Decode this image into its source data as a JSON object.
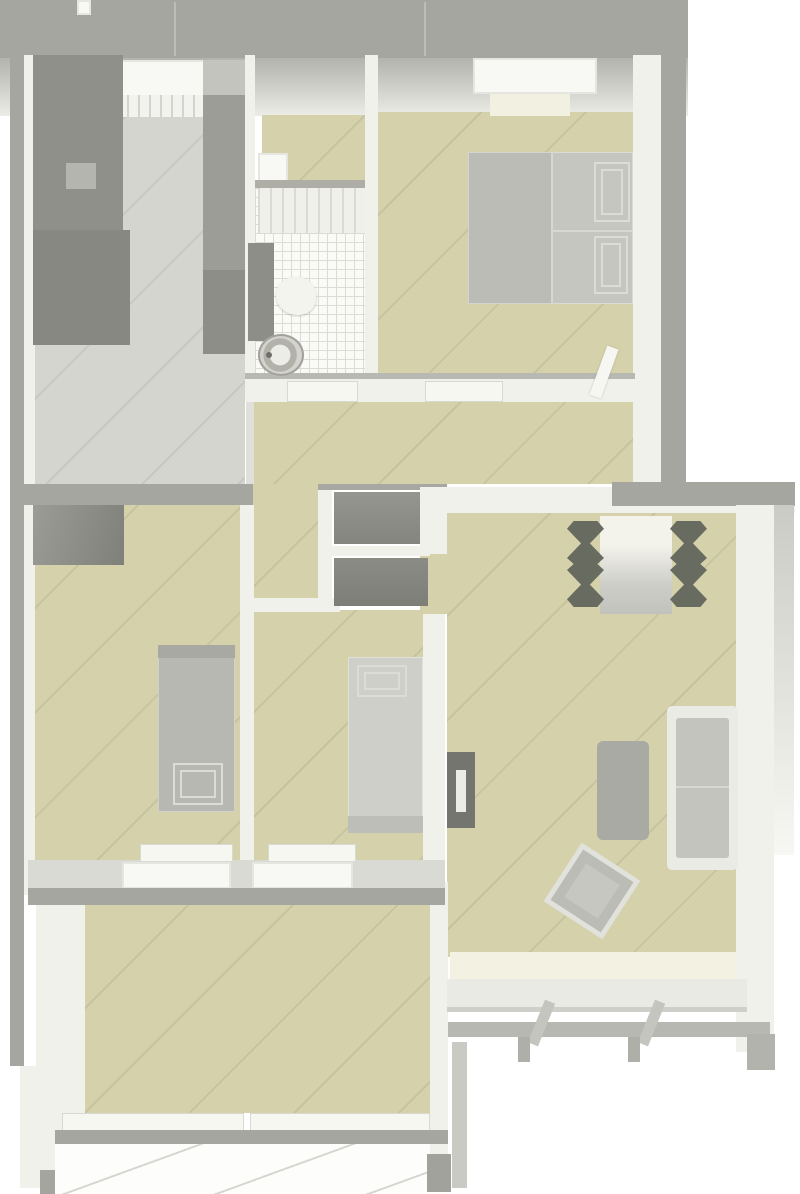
{
  "scene": {
    "width": 800,
    "height": 1194,
    "background": "#ffffff"
  },
  "palette": {
    "background": "#ffffff",
    "exterior_wall": "#a6a6a1",
    "interior_wall": "#f0f1eb",
    "floor_wood_beige": "#d5d2ab",
    "floor_kitchen_gray": "#d4d5ce",
    "floor_bathroom_tile": "#fafaf7",
    "balcony_tile": "#fdfdfb",
    "furniture_light": "#c6c6c1",
    "furniture_dark": "#8f908a",
    "chair_dark": "#686b60"
  },
  "rooms": [
    {
      "name": "kitchen",
      "x": 35,
      "y": 55,
      "w": 210,
      "h": 429
    },
    {
      "name": "bathroom",
      "x": 255,
      "y": 115,
      "w": 110,
      "h": 258
    },
    {
      "name": "bedroom",
      "x": 378,
      "y": 112,
      "w": 255,
      "h": 261
    },
    {
      "name": "hallway",
      "x": 253,
      "y": 402,
      "w": 380,
      "h": 208
    },
    {
      "name": "bedroom-left",
      "x": 35,
      "y": 505,
      "w": 205,
      "h": 357
    },
    {
      "name": "child-room",
      "x": 253,
      "y": 610,
      "w": 170,
      "h": 252
    },
    {
      "name": "living-room",
      "x": 447,
      "y": 513,
      "w": 289,
      "h": 444
    },
    {
      "name": "bottom-room",
      "x": 85,
      "y": 905,
      "w": 345,
      "h": 208
    },
    {
      "name": "balcony",
      "x": 55,
      "y": 1143,
      "w": 393,
      "h": 51
    }
  ],
  "items": [
    {
      "name": "top-exterior-wall",
      "kind": "wall-gray",
      "x": 0,
      "y": 0,
      "w": 688,
      "h": 58
    },
    {
      "name": "top-wall-notch",
      "kind": "window",
      "x": 77,
      "y": 0,
      "w": 14,
      "h": 15
    },
    {
      "name": "top-wall-seam-a",
      "kind": "seam-faint",
      "x": 174,
      "y": 2,
      "w": 2,
      "h": 54
    },
    {
      "name": "top-wall-seam-b",
      "kind": "seam-faint",
      "x": 424,
      "y": 2,
      "w": 2,
      "h": 54
    },
    {
      "name": "north-wall-fade",
      "kind": "fade-n",
      "x": 0,
      "y": 58,
      "w": 688,
      "h": 58
    },
    {
      "name": "left-exterior-wall",
      "kind": "wall-gray",
      "x": 10,
      "y": 44,
      "w": 14,
      "h": 1022
    },
    {
      "name": "left-interior-wall",
      "kind": "wall-white",
      "x": 24,
      "y": 55,
      "w": 12,
      "h": 840
    },
    {
      "name": "lowerleft-interior-wall",
      "kind": "wall-white",
      "x": 36,
      "y": 896,
      "w": 49,
      "h": 276
    },
    {
      "name": "lowerleft-wall-base",
      "kind": "wall-white",
      "x": 20,
      "y": 1066,
      "w": 24,
      "h": 122
    },
    {
      "name": "lowerleft-wall-foot",
      "kind": "rect",
      "color": "#a5a5a0",
      "x": 40,
      "y": 1170,
      "w": 48,
      "h": 24
    },
    {
      "name": "right-interior-wall",
      "kind": "wall-white",
      "x": 633,
      "y": 55,
      "w": 28,
      "h": 433
    },
    {
      "name": "right-exterior-wall",
      "kind": "wall-gray",
      "x": 661,
      "y": 44,
      "w": 25,
      "h": 444
    },
    {
      "name": "kitchen-floor",
      "kind": "floor-gray",
      "x": 35,
      "y": 112,
      "w": 210,
      "h": 372
    },
    {
      "name": "anteroom-floor",
      "kind": "floor-beige",
      "x": 262,
      "y": 115,
      "w": 103,
      "h": 65
    },
    {
      "name": "anteroom-fixture",
      "kind": "window",
      "x": 258,
      "y": 153,
      "w": 30,
      "h": 29
    },
    {
      "name": "anteroom-wall-line",
      "kind": "rect",
      "color": "#aeaea7",
      "x": 245,
      "y": 180,
      "w": 120,
      "h": 8
    },
    {
      "name": "bathroom-tile-floor",
      "kind": "tile-floor",
      "x": 255,
      "y": 188,
      "w": 110,
      "h": 185
    },
    {
      "name": "bathroom-shower-zone",
      "kind": "shower",
      "x": 258,
      "y": 188,
      "w": 107,
      "h": 45
    },
    {
      "name": "bedroom-floor",
      "kind": "floor-beige",
      "x": 378,
      "y": 112,
      "w": 255,
      "h": 261
    },
    {
      "name": "hallway-floor",
      "kind": "floor-beige",
      "x": 253,
      "y": 402,
      "w": 380,
      "h": 82
    },
    {
      "name": "hallway-floor-left",
      "kind": "floor-beige",
      "x": 253,
      "y": 484,
      "w": 67,
      "h": 126
    },
    {
      "name": "bedroomleft-floor",
      "kind": "floor-beige",
      "x": 35,
      "y": 505,
      "w": 205,
      "h": 357
    },
    {
      "name": "childroom-floor",
      "kind": "floor-beige",
      "x": 253,
      "y": 610,
      "w": 170,
      "h": 252
    },
    {
      "name": "livingroom-floor",
      "kind": "floor-beige",
      "x": 447,
      "y": 513,
      "w": 289,
      "h": 444
    },
    {
      "name": "livingroom-doorway-floor",
      "kind": "floor-beige",
      "x": 420,
      "y": 552,
      "w": 27,
      "h": 62
    },
    {
      "name": "bottomroom-floor",
      "kind": "floor-beige",
      "x": 85,
      "y": 905,
      "w": 345,
      "h": 208
    },
    {
      "name": "balcony-tile-floor",
      "kind": "balcony",
      "x": 55,
      "y": 1143,
      "w": 393,
      "h": 51
    },
    {
      "name": "kitchen-bath-wall",
      "kind": "wall-white",
      "x": 245,
      "y": 55,
      "w": 10,
      "h": 340
    },
    {
      "name": "kitchen-hall-threshold",
      "kind": "rect",
      "color": "#e0e0da",
      "x": 246,
      "y": 395,
      "w": 8,
      "h": 89
    },
    {
      "name": "bath-bedroom-wall",
      "kind": "wall-white",
      "x": 365,
      "y": 55,
      "w": 13,
      "h": 318
    },
    {
      "name": "south-wall-edge",
      "kind": "rect",
      "color": "#b9b9b3",
      "x": 245,
      "y": 373,
      "w": 390,
      "h": 7
    },
    {
      "name": "south-wall",
      "kind": "wall-white",
      "x": 245,
      "y": 379,
      "w": 390,
      "h": 23
    },
    {
      "name": "bathroom-door-sill",
      "kind": "sill",
      "x": 287,
      "y": 381,
      "w": 71,
      "h": 21
    },
    {
      "name": "bedroom-door-sill",
      "kind": "sill",
      "x": 425,
      "y": 381,
      "w": 78,
      "h": 21
    },
    {
      "name": "bedroom-door-leaf",
      "kind": "door-leaf",
      "x": 598,
      "y": 346,
      "w": 12,
      "h": 52,
      "rot": 20
    },
    {
      "name": "kitchen-south-beam",
      "kind": "wall-gray",
      "x": 10,
      "y": 484,
      "w": 243,
      "h": 21
    },
    {
      "name": "bedroomleft-childroom-wall",
      "kind": "wall-white",
      "x": 240,
      "y": 505,
      "w": 14,
      "h": 357
    },
    {
      "name": "hallway-childroom-wall",
      "kind": "wall-white",
      "x": 240,
      "y": 598,
      "w": 100,
      "h": 14
    },
    {
      "name": "closet-left-wall",
      "kind": "wall-white",
      "x": 318,
      "y": 484,
      "w": 14,
      "h": 124
    },
    {
      "name": "closet-mid-wall",
      "kind": "wall-white",
      "x": 322,
      "y": 546,
      "w": 108,
      "h": 10
    },
    {
      "name": "closet-top-line",
      "kind": "rect",
      "color": "#a8a8a2",
      "x": 318,
      "y": 484,
      "w": 129,
      "h": 6
    },
    {
      "name": "closet-shelf-upper",
      "kind": "shelf",
      "x": 334,
      "y": 492,
      "w": 94,
      "h": 52
    },
    {
      "name": "closet-shelf-lower",
      "kind": "shelf2",
      "x": 334,
      "y": 558,
      "w": 94,
      "h": 48
    },
    {
      "name": "livingroom-top-wall",
      "kind": "wall-white",
      "x": 420,
      "y": 487,
      "w": 375,
      "h": 26
    },
    {
      "name": "livingroom-top-wall-edge",
      "kind": "wall-gray",
      "x": 612,
      "y": 482,
      "w": 183,
      "h": 24
    },
    {
      "name": "livingroom-left-wall",
      "kind": "wall-white",
      "x": 420,
      "y": 487,
      "w": 27,
      "h": 67
    },
    {
      "name": "childroom-livingroom-wall",
      "kind": "wall-white",
      "x": 423,
      "y": 614,
      "w": 22,
      "h": 268
    },
    {
      "name": "livingroom-right-wall",
      "kind": "wall-white",
      "x": 736,
      "y": 505,
      "w": 38,
      "h": 547
    },
    {
      "name": "livingroom-right-outer",
      "kind": "outer-fade",
      "x": 774,
      "y": 505,
      "w": 20,
      "h": 350
    },
    {
      "name": "bottomroom-livingroom-wall",
      "kind": "wall-white",
      "x": 430,
      "y": 882,
      "w": 18,
      "h": 272
    },
    {
      "name": "bottomroom-wall-foot",
      "kind": "rect",
      "color": "#a2a29d",
      "x": 427,
      "y": 1154,
      "w": 24,
      "h": 38
    },
    {
      "name": "livingroom-bay-strip",
      "kind": "rect",
      "color": "#c9cac4",
      "x": 452,
      "y": 1042,
      "w": 15,
      "h": 146
    },
    {
      "name": "loggia-band",
      "kind": "rect",
      "color": "#dadad4",
      "x": 28,
      "y": 860,
      "w": 417,
      "h": 30
    },
    {
      "name": "bedroomleft-window-sill",
      "kind": "sill",
      "x": 140,
      "y": 844,
      "w": 93,
      "h": 18
    },
    {
      "name": "childroom-window-sill",
      "kind": "sill",
      "x": 268,
      "y": 844,
      "w": 88,
      "h": 18
    },
    {
      "name": "bedroomleft-window-frame",
      "kind": "window",
      "x": 122,
      "y": 862,
      "w": 109,
      "h": 27
    },
    {
      "name": "childroom-window-frame",
      "kind": "window",
      "x": 252,
      "y": 862,
      "w": 101,
      "h": 27
    },
    {
      "name": "loggia-beam",
      "kind": "wall-gray",
      "x": 28,
      "y": 888,
      "w": 417,
      "h": 17
    },
    {
      "name": "bottomroom-sill-left",
      "kind": "sill",
      "x": 62,
      "y": 1113,
      "w": 182,
      "h": 19
    },
    {
      "name": "bottomroom-sill-right",
      "kind": "sill",
      "x": 250,
      "y": 1113,
      "w": 180,
      "h": 19
    },
    {
      "name": "bottom-beam",
      "kind": "wall-gray",
      "x": 55,
      "y": 1130,
      "w": 393,
      "h": 14
    },
    {
      "name": "kitchen-window",
      "kind": "window",
      "x": 108,
      "y": 60,
      "w": 100,
      "h": 40
    },
    {
      "name": "kitchen-radiator",
      "kind": "slats",
      "x": 116,
      "y": 95,
      "w": 88,
      "h": 22
    },
    {
      "name": "kitchen-cabinet-left",
      "kind": "cabinet-dark",
      "x": 33,
      "y": 55,
      "w": 90,
      "h": 175
    },
    {
      "name": "kitchen-counter-left",
      "kind": "rect",
      "color": "#878881",
      "x": 33,
      "y": 230,
      "w": 97,
      "h": 115
    },
    {
      "name": "kitchen-cabinet-handle",
      "kind": "rect",
      "color": "#b4b5ae",
      "x": 66,
      "y": 163,
      "w": 30,
      "h": 26
    },
    {
      "name": "kitchen-cabinet-right-top",
      "kind": "rect",
      "color": "#c3c4bd",
      "x": 203,
      "y": 60,
      "w": 42,
      "h": 35
    },
    {
      "name": "kitchen-cabinet-right",
      "kind": "rect",
      "color": "#9c9d96",
      "x": 203,
      "y": 95,
      "w": 42,
      "h": 175
    },
    {
      "name": "kitchen-cabinet-right-lower",
      "kind": "rect",
      "color": "#8d8e87",
      "x": 203,
      "y": 270,
      "w": 42,
      "h": 84
    },
    {
      "name": "bathroom-cabinet",
      "kind": "rect",
      "color": "#8d8e87",
      "x": 248,
      "y": 243,
      "w": 26,
      "h": 98
    },
    {
      "name": "bathroom-basin",
      "kind": "basin",
      "x": 276,
      "y": 277,
      "w": 40,
      "h": 38
    },
    {
      "name": "bathroom-toilet",
      "kind": "toilet",
      "x": 258,
      "y": 334,
      "w": 46,
      "h": 42
    },
    {
      "name": "bedroom-window",
      "kind": "window",
      "x": 473,
      "y": 58,
      "w": 124,
      "h": 36
    },
    {
      "name": "bedroom-window-sill",
      "kind": "rect",
      "color": "#f2f1e1",
      "x": 490,
      "y": 94,
      "w": 80,
      "h": 22
    },
    {
      "name": "double-bed-left",
      "kind": "bedpart",
      "color": "#bcbcb7",
      "x": 468,
      "y": 152,
      "w": 84,
      "h": 152
    },
    {
      "name": "double-bed-right",
      "kind": "bedpart",
      "color": "#c6c6c1",
      "x": 552,
      "y": 152,
      "w": 81,
      "h": 152
    },
    {
      "name": "double-bed-seam",
      "kind": "seam",
      "x": 551,
      "y": 152,
      "w": 2,
      "h": 152
    },
    {
      "name": "double-bed-seam-h",
      "kind": "seam",
      "x": 552,
      "y": 230,
      "w": 81,
      "h": 2
    },
    {
      "name": "double-bed-quilt-upper",
      "kind": "quilt",
      "x": 594,
      "y": 162,
      "w": 36,
      "h": 60
    },
    {
      "name": "double-bed-quilt-lower",
      "kind": "quilt",
      "x": 594,
      "y": 236,
      "w": 34,
      "h": 58
    },
    {
      "name": "bedroomleft-wardrobe",
      "kind": "wardrobe",
      "x": 33,
      "y": 505,
      "w": 91,
      "h": 60
    },
    {
      "name": "single-bed-left",
      "kind": "bedpart",
      "color": "#b8b8b3",
      "x": 158,
      "y": 645,
      "w": 77,
      "h": 167
    },
    {
      "name": "single-bed-left-head",
      "kind": "rect",
      "color": "#a9a9a4",
      "x": 158,
      "y": 645,
      "w": 77,
      "h": 13
    },
    {
      "name": "single-bed-left-quilt",
      "kind": "quilt",
      "x": 173,
      "y": 763,
      "w": 50,
      "h": 42
    },
    {
      "name": "single-bed-center",
      "kind": "bedpart",
      "color": "#cfcfca",
      "x": 348,
      "y": 657,
      "w": 75,
      "h": 176
    },
    {
      "name": "single-bed-center-quilt",
      "kind": "quilt",
      "x": 357,
      "y": 665,
      "w": 50,
      "h": 32
    },
    {
      "name": "single-bed-center-foot",
      "kind": "rect",
      "color": "#bebeb9",
      "x": 348,
      "y": 816,
      "w": 75,
      "h": 17
    },
    {
      "name": "dining-table",
      "kind": "table",
      "x": 600,
      "y": 516,
      "w": 72,
      "h": 98
    },
    {
      "name": "dining-chair-left",
      "kind": "chair",
      "x": 567,
      "y": 521,
      "w": 37,
      "h": 86
    },
    {
      "name": "dining-chair-right",
      "kind": "chair",
      "x": 670,
      "y": 521,
      "w": 37,
      "h": 86
    },
    {
      "name": "livingroom-radiator",
      "kind": "rect",
      "color": "#74756e",
      "x": 447,
      "y": 752,
      "w": 28,
      "h": 76
    },
    {
      "name": "livingroom-radiator-handle",
      "kind": "rect",
      "color": "#ecece6",
      "x": 456,
      "y": 770,
      "w": 10,
      "h": 42
    },
    {
      "name": "coffee-table",
      "kind": "rect",
      "color": "#a9aaa4",
      "radius": 6,
      "x": 597,
      "y": 741,
      "w": 52,
      "h": 99
    },
    {
      "name": "sofa-frame",
      "kind": "rect",
      "color": "#eaebe5",
      "radius": 5,
      "x": 667,
      "y": 706,
      "w": 71,
      "h": 164
    },
    {
      "name": "sofa-seat",
      "kind": "rect",
      "color": "#c3c4be",
      "radius": 3,
      "x": 676,
      "y": 718,
      "w": 53,
      "h": 140
    },
    {
      "name": "sofa-seat-seam",
      "kind": "seam",
      "x": 676,
      "y": 786,
      "w": 53,
      "h": 2
    },
    {
      "name": "armchair-tilted",
      "kind": "armchair",
      "x": 557,
      "y": 856,
      "w": 70,
      "h": 70,
      "rot": 33
    },
    {
      "name": "window-bench-top",
      "kind": "rect",
      "color": "#f2f1e2",
      "x": 450,
      "y": 952,
      "w": 286,
      "h": 27
    },
    {
      "name": "window-bench-front",
      "kind": "rect",
      "color": "#eaeae4",
      "x": 447,
      "y": 979,
      "w": 300,
      "h": 30
    },
    {
      "name": "window-bench-edge",
      "kind": "rect",
      "color": "#cfcfc9",
      "x": 447,
      "y": 1007,
      "w": 300,
      "h": 5
    },
    {
      "name": "bay-window-bar",
      "kind": "rect",
      "color": "#b7b8b2",
      "x": 448,
      "y": 1022,
      "w": 322,
      "h": 15
    },
    {
      "name": "bay-post-left",
      "kind": "rect",
      "color": "#c4c5bf",
      "x": 536,
      "y": 1000,
      "w": 11,
      "h": 46,
      "rot": 22
    },
    {
      "name": "bay-post-right",
      "kind": "rect",
      "color": "#c4c5bf",
      "x": 646,
      "y": 1000,
      "w": 11,
      "h": 46,
      "rot": 22
    },
    {
      "name": "bay-foot-left",
      "kind": "rect",
      "color": "#aeafa9",
      "x": 518,
      "y": 1037,
      "w": 12,
      "h": 25
    },
    {
      "name": "bay-foot-right",
      "kind": "rect",
      "color": "#aeafa9",
      "x": 628,
      "y": 1037,
      "w": 12,
      "h": 25
    },
    {
      "name": "bay-corner-foot",
      "kind": "rect",
      "color": "#b2b3ad",
      "x": 747,
      "y": 1034,
      "w": 28,
      "h": 36
    }
  ]
}
